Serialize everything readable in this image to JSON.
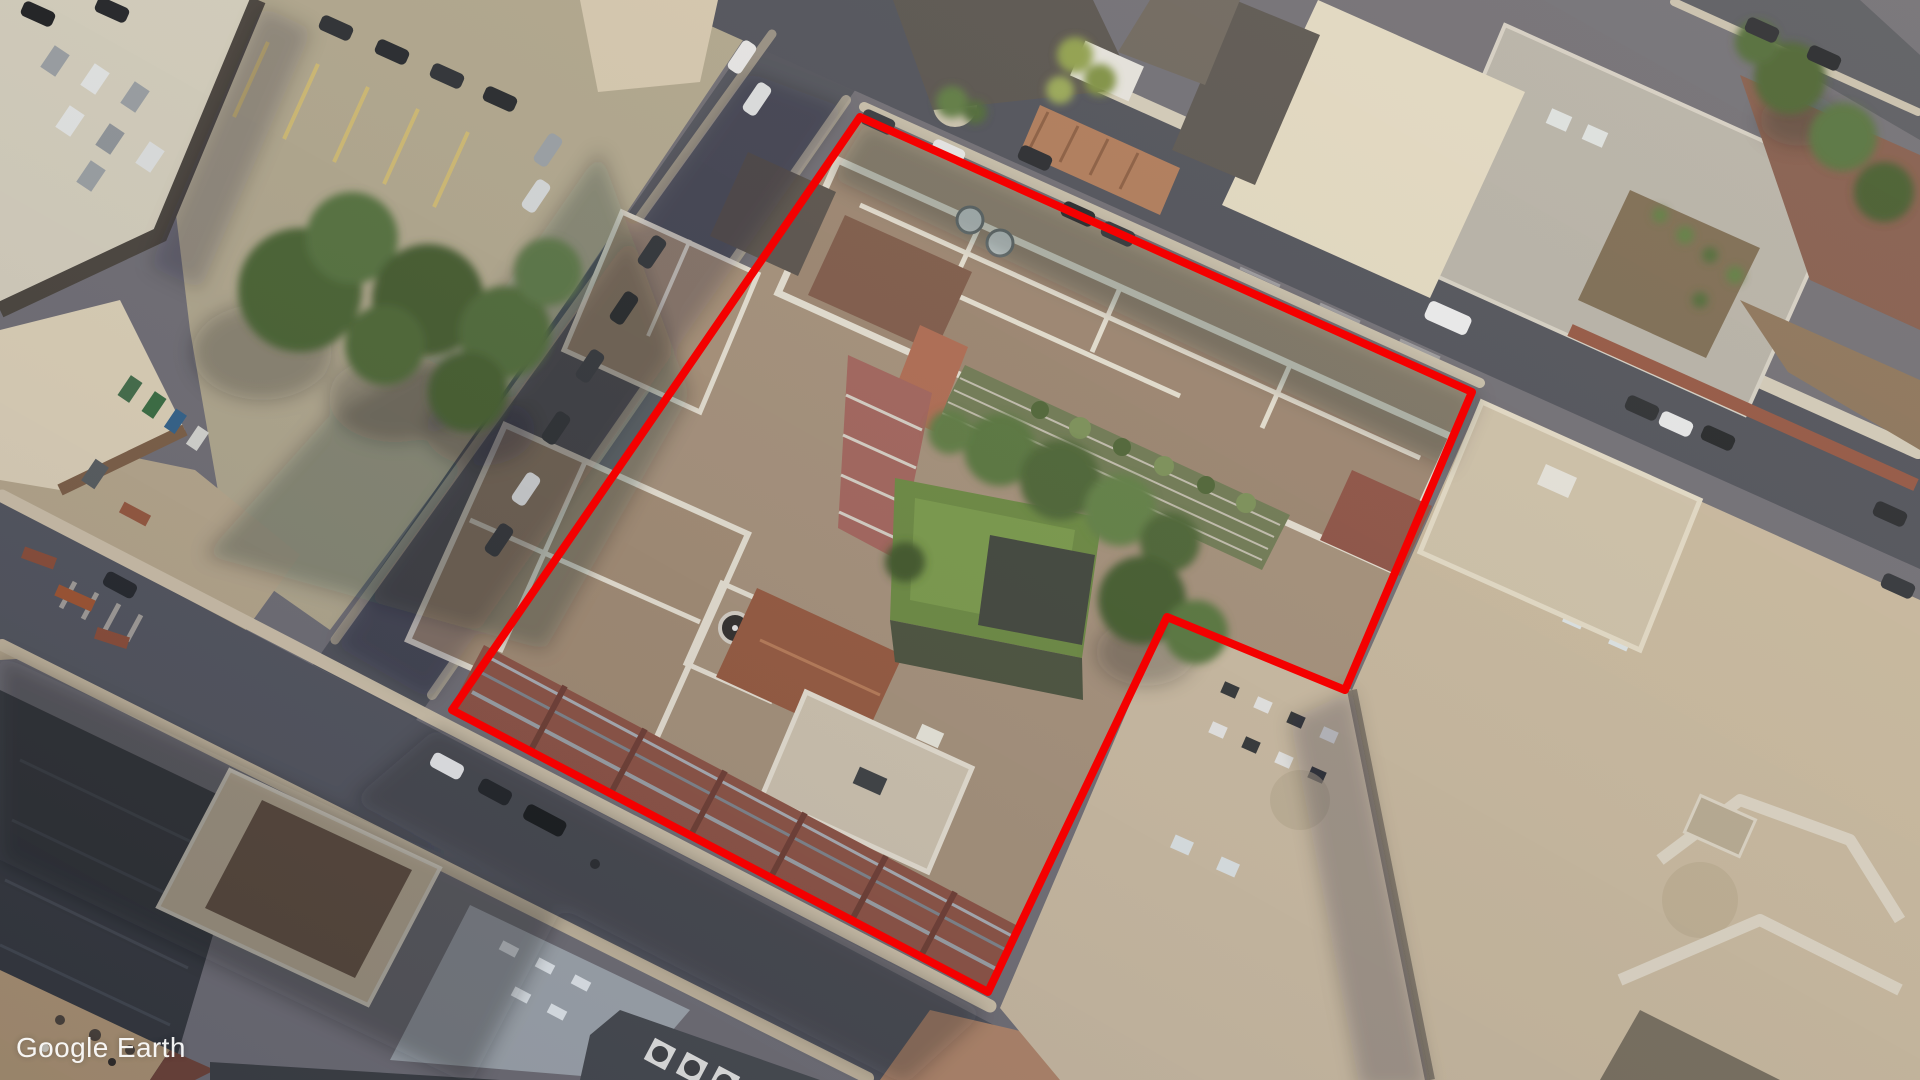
{
  "app": {
    "watermark": "Google Earth"
  },
  "annotation": {
    "label": "site-boundary-outline",
    "color": "#f40000",
    "stroke_width": 8,
    "points": [
      [
        860,
        117
      ],
      [
        1472,
        392
      ],
      [
        1345,
        690
      ],
      [
        1167,
        617
      ],
      [
        988,
        992
      ],
      [
        452,
        710
      ]
    ],
    "points_str": "860,117 1472,392 1345,690 1167,617 988,992 452,710"
  },
  "scene": {
    "type": "aerial-satellite-photo",
    "palette": {
      "asphalt_shadow": "#53555f",
      "pavement_tan": "#b2a88e",
      "roof_gravel": "#a5907a",
      "parapet_white": "#e8e2d4",
      "lawn_green": "#69893f",
      "tree_green": "#4b6431",
      "brick_red": "#8b4f41",
      "shadow": "#14161c"
    }
  }
}
